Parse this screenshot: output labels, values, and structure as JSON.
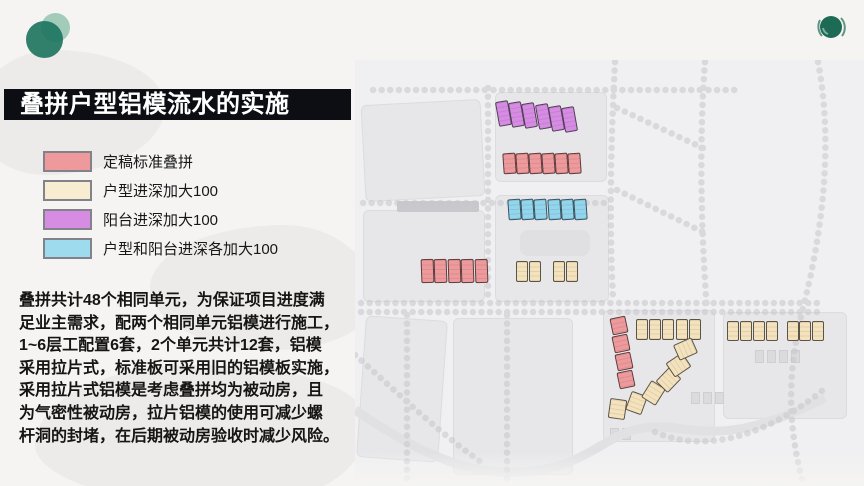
{
  "slide": {
    "title": "叠拼户型铝模流水的实施",
    "title_bg": "#0c0e13",
    "title_color": "#ffffff",
    "logo_color_dark": "#1e7561",
    "logo_color_light": "#5fa98c"
  },
  "legend": {
    "items": [
      {
        "label": "定稿标准叠拼",
        "color": "#ee9a9c"
      },
      {
        "label": "户型进深加大100",
        "color": "#f8ecd1"
      },
      {
        "label": "阳台进深加大100",
        "color": "#d78ce4"
      },
      {
        "label": "户型和阳台进深各加大100",
        "color": "#9edbee"
      }
    ]
  },
  "body": {
    "text": "叠拼共计48个相同单元，为保证项目进度满\n足业主需求，配两个相同单元铝模进行施工，\n1~6层工配置6套，2个单元共计12套，铝模\n采用拉片式，标准板可采用旧的铝模板实施，\n采用拉片式铝模是考虑叠拼均为被动房，且\n为气密性被动房，拉片铝模的使用可减少螺\n杆洞的封堵，在后期被动房验收时减少风险。"
  },
  "map": {
    "block_format": [
      "x",
      "y",
      "w",
      "h",
      "rotation_deg"
    ],
    "block_colors": {
      "standard": "#ee9a9c",
      "unit": "#f4e2bd",
      "balcony": "#d78ce4",
      "both": "#92d5ec"
    },
    "clusters": [
      {
        "name": "balcony-row-6",
        "color": "balcony",
        "blocks": [
          [
            497,
            101,
            12.5,
            25,
            -10
          ],
          [
            510,
            102,
            12.5,
            25,
            -10
          ],
          [
            523,
            103,
            12.5,
            25,
            -10
          ],
          [
            537,
            104,
            12.5,
            25,
            -10
          ],
          [
            550,
            106,
            12.5,
            25,
            -10
          ],
          [
            563,
            107,
            12.5,
            25,
            -10
          ]
        ]
      },
      {
        "name": "standard-row-6",
        "color": "standard",
        "blocks": [
          [
            503,
            153,
            12.5,
            21,
            -4
          ],
          [
            516,
            153,
            12.5,
            21,
            -4
          ],
          [
            529,
            153,
            12.5,
            21,
            -4
          ],
          [
            542,
            153,
            12.5,
            21,
            -4
          ],
          [
            555,
            153,
            12.5,
            21,
            -4
          ],
          [
            568,
            153,
            12.5,
            21,
            -4
          ]
        ]
      },
      {
        "name": "both-row-6",
        "color": "both",
        "blocks": [
          [
            508,
            199,
            12.5,
            21,
            -4
          ],
          [
            521,
            199,
            12.5,
            21,
            -4
          ],
          [
            534,
            199,
            12.5,
            21,
            -4
          ],
          [
            548,
            199,
            12.5,
            21,
            -4
          ],
          [
            561,
            199,
            12.5,
            21,
            -4
          ],
          [
            574,
            199,
            12.5,
            21,
            -4
          ]
        ]
      },
      {
        "name": "standard-row-5",
        "color": "standard",
        "blocks": [
          [
            421,
            259,
            12.5,
            24,
            -2
          ],
          [
            434,
            259,
            12.5,
            24,
            -2
          ],
          [
            448,
            259,
            12.5,
            24,
            -2
          ],
          [
            461,
            259,
            12.5,
            24,
            -2
          ],
          [
            475,
            259,
            12.5,
            24,
            -2
          ]
        ]
      },
      {
        "name": "unit-pairs",
        "color": "unit",
        "blocks": [
          [
            516,
            261,
            12,
            21,
            0
          ],
          [
            529,
            261,
            12,
            21,
            0
          ],
          [
            553,
            261,
            12,
            21,
            0
          ],
          [
            566,
            261,
            12,
            21,
            0
          ]
        ]
      },
      {
        "name": "standard-column-4",
        "color": "standard",
        "blocks": [
          [
            611,
            317,
            16,
            17,
            -12
          ],
          [
            613,
            335,
            16,
            17,
            -12
          ],
          [
            616,
            353,
            16,
            17,
            -12
          ],
          [
            618,
            371,
            16,
            17,
            -12
          ]
        ]
      },
      {
        "name": "unit-row-5",
        "color": "unit",
        "blocks": [
          [
            636,
            319,
            12,
            21,
            0
          ],
          [
            649,
            319,
            12,
            21,
            0
          ],
          [
            662,
            319,
            12,
            21,
            0
          ],
          [
            676,
            319,
            12,
            21,
            0
          ],
          [
            689,
            319,
            12,
            21,
            0
          ]
        ]
      },
      {
        "name": "unit-row-4",
        "color": "unit",
        "blocks": [
          [
            727,
            321,
            12,
            20,
            0
          ],
          [
            740,
            321,
            12,
            20,
            0
          ],
          [
            753,
            321,
            12,
            20,
            0
          ],
          [
            766,
            321,
            12,
            20,
            0
          ]
        ]
      },
      {
        "name": "unit-row-3",
        "color": "unit",
        "blocks": [
          [
            787,
            321,
            12,
            20,
            0
          ],
          [
            799,
            321,
            12,
            20,
            0
          ],
          [
            812,
            321,
            12,
            20,
            0
          ]
        ]
      },
      {
        "name": "unit-arc-6",
        "color": "unit",
        "blocks": [
          [
            609,
            399,
            17,
            20,
            8
          ],
          [
            628,
            393,
            17,
            20,
            20
          ],
          [
            645,
            383,
            17,
            20,
            32
          ],
          [
            660,
            370,
            17,
            20,
            44
          ],
          [
            670,
            355,
            17,
            20,
            56
          ],
          [
            677,
            339,
            17,
            20,
            66
          ]
        ]
      }
    ]
  }
}
